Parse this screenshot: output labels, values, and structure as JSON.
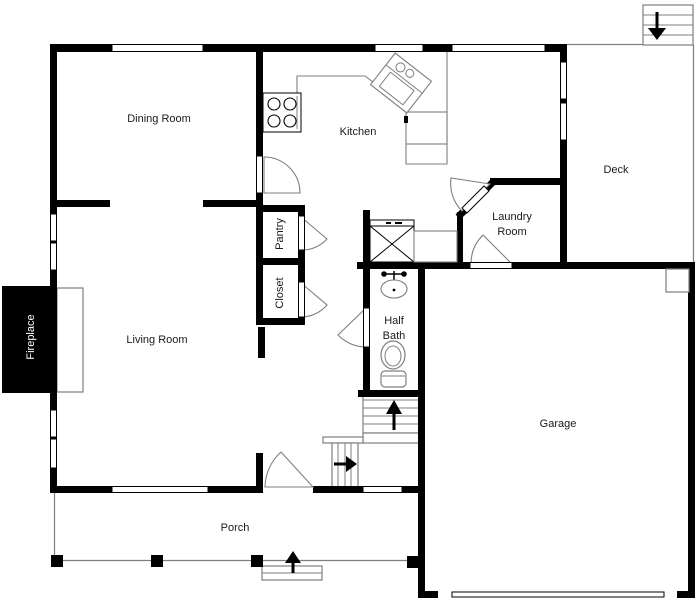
{
  "colors": {
    "wall": "#000000",
    "thin_line": "#7f7f7f",
    "background": "#ffffff",
    "label": "#1a1a1a",
    "fireplace_label": "#ffffff"
  },
  "rooms": {
    "dining_room": {
      "label": "Dining Room"
    },
    "kitchen": {
      "label": "Kitchen"
    },
    "deck": {
      "label": "Deck"
    },
    "laundry_room": {
      "label_line1": "Laundry",
      "label_line2": "Room"
    },
    "pantry": {
      "label": "Pantry"
    },
    "closet": {
      "label": "Closet"
    },
    "living_room": {
      "label": "Living Room"
    },
    "half_bath": {
      "label_line1": "Half",
      "label_line2": "Bath"
    },
    "garage": {
      "label": "Garage"
    },
    "porch": {
      "label": "Porch"
    }
  },
  "features": {
    "fireplace": {
      "label": "Fireplace"
    }
  },
  "stairs": {
    "deck_stairs": {
      "direction": "down"
    },
    "main_stairs": {
      "direction": "up"
    },
    "lower_stairs": {
      "direction": "right"
    },
    "porch_steps": {
      "direction": "up"
    }
  }
}
